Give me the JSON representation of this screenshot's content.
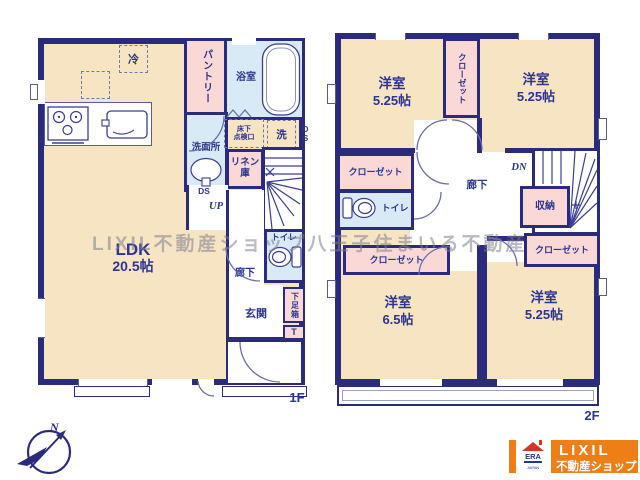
{
  "watermark": "LIXIL不動産ショップ八王子住まいる不動産",
  "f1": {
    "floor_label": "1F",
    "ldk_name": "LDK",
    "ldk_size": "20.5帖",
    "pantry": "パントリー",
    "bath": "浴室",
    "washroom": "洗面所",
    "linen_1": "リネン",
    "linen_2": "庫",
    "underfloor_1": "床下",
    "underfloor_2": "点検口",
    "washer": "洗",
    "fridge": "冷",
    "toilet": "トイレ",
    "hallway": "廊下",
    "entrance": "玄関",
    "shoebox": "下足箱",
    "shoebox_t": "T",
    "ds_side": "DS",
    "ds": "DS",
    "up": "UP"
  },
  "f2": {
    "floor_label": "2F",
    "room_nw_name": "洋室",
    "room_nw_size": "5.25帖",
    "room_ne_name": "洋室",
    "room_ne_size": "5.25帖",
    "room_sw_name": "洋室",
    "room_sw_size": "6.5帖",
    "room_se_name": "洋室",
    "room_se_size": "5.25帖",
    "closet_top": "クローゼット",
    "closet_w": "クローゼット",
    "closet_sw": "クローゼット",
    "closet_se": "クローゼット",
    "toilet": "トイレ",
    "hallway": "廊下",
    "storage": "収納",
    "dn": "DN"
  },
  "compass": {
    "north": "N"
  },
  "logo": {
    "era": "ERA",
    "era_sub": "JAPAN",
    "brand": "LIXIL",
    "brand_sub": "不動産ショップ"
  },
  "colors": {
    "wall": "#2b2b7d",
    "room_beige": "#f7e4c3",
    "room_pink": "#f9d8d6",
    "room_blue": "#d9eaf7",
    "brand_orange": "#ee7f17",
    "label_blue": "#2c3590"
  }
}
